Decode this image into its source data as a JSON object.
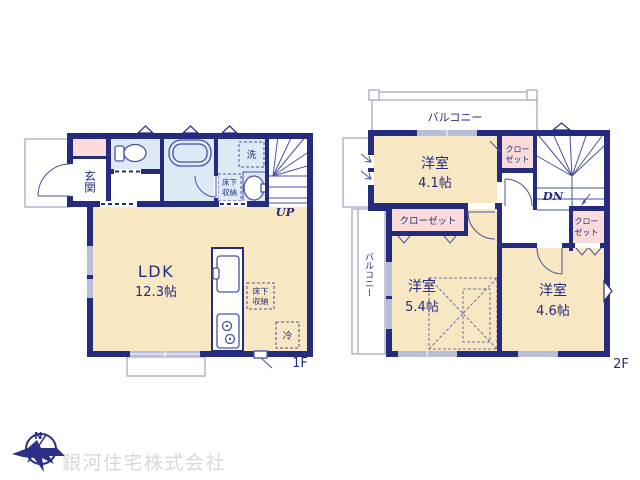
{
  "colors": {
    "wall": "#252b7d",
    "fixline": "#4a51a3",
    "floor": "#f8e7c3",
    "wet": "#dde9f4",
    "closet": "#fbdbd9",
    "window": "#b8bed8",
    "rail": "#a6aac6",
    "logo": "#2b2f85",
    "logo_text": "#d8d8d8"
  },
  "floor1": {
    "label": "1F",
    "genkan": "玄関",
    "laundry": "洗",
    "underfloor_wash_l1": "床下",
    "underfloor_wash_l2": "収納",
    "ldk_name": "LDK",
    "ldk_size": "12.3帖",
    "underfloor_ldk_l1": "床下",
    "underfloor_ldk_l2": "収納",
    "fridge": "冷",
    "up": "UP"
  },
  "floor2": {
    "label": "2F",
    "balcony_top": "バルコニー",
    "balcony_left": "バルコニー",
    "closet_mid_l1": "クロー",
    "closet_mid_l2": "ゼット",
    "closet_long": "クローゼット",
    "closet_right_l1": "クロー",
    "closet_right_l2": "ゼット",
    "room_41_name": "洋室",
    "room_41_size": "4.1帖",
    "room_54_name": "洋室",
    "room_54_size": "5.4帖",
    "room_46_name": "洋室",
    "room_46_size": "4.6帖",
    "dn": "DN"
  },
  "footer": {
    "compass_n": "N",
    "company": "銀河住宅株式会社"
  }
}
